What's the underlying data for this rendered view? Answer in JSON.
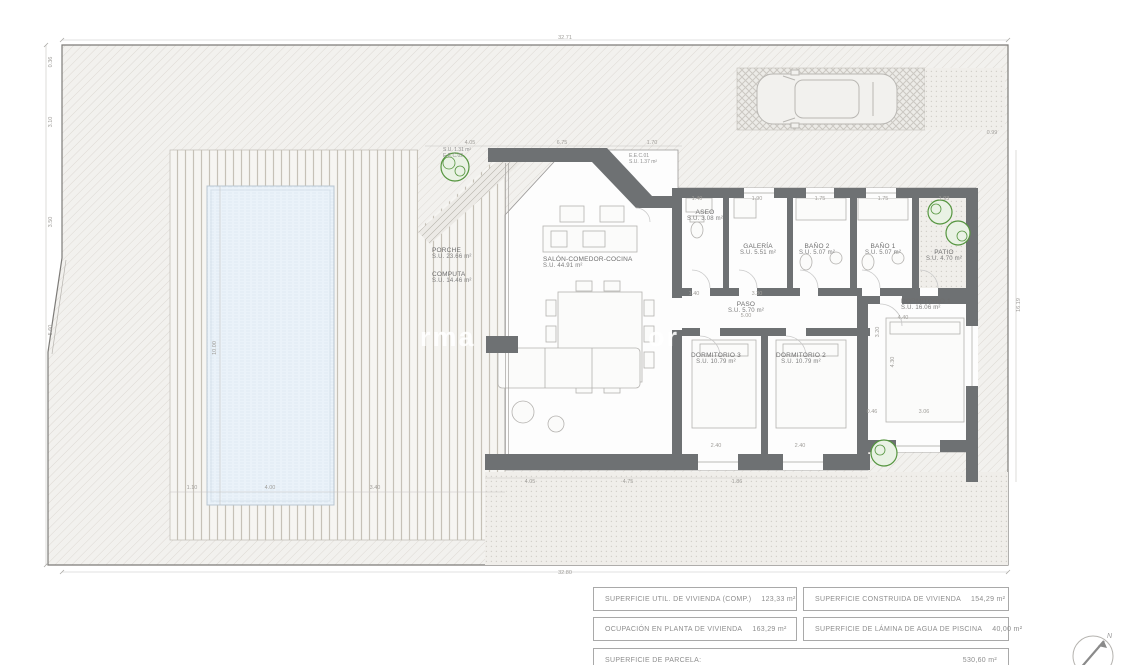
{
  "plan": {
    "rooms": [
      {
        "name": "PORCHE",
        "area": "S.U. 23.66 m²",
        "x": 432,
        "y": 247,
        "align": "left"
      },
      {
        "name": "COMPUTA",
        "area": "S.U. 14.46 m²",
        "x": 432,
        "y": 271,
        "align": "left"
      },
      {
        "name": "SALÓN-COMEDOR-COCINA",
        "area": "S.U. 44.91 m²",
        "x": 543,
        "y": 256,
        "align": "left"
      },
      {
        "name": "ASEO",
        "area": "S.U. 3.08 m²",
        "x": 705,
        "y": 209,
        "align": "center"
      },
      {
        "name": "GALERÍA",
        "area": "S.U. 5.51 m²",
        "x": 758,
        "y": 243,
        "align": "center"
      },
      {
        "name": "BAÑO 2",
        "area": "S.U. 5.07 m²",
        "x": 817,
        "y": 243,
        "align": "center"
      },
      {
        "name": "BAÑO 1",
        "area": "S.U. 5.07 m²",
        "x": 883,
        "y": 243,
        "align": "center"
      },
      {
        "name": "PATIO",
        "area": "S.U. 4.70 m²",
        "x": 944,
        "y": 249,
        "align": "center"
      },
      {
        "name": "PASO",
        "area": "S.U. 5.70 m²",
        "x": 746,
        "y": 301,
        "align": "center"
      },
      {
        "name": "DORMITORIO 1",
        "area": "S.U. 16.06 m²",
        "x": 901,
        "y": 298,
        "align": "left"
      },
      {
        "name": "DORMITORIO 3",
        "area": "S.U. 10.79 m²",
        "x": 716,
        "y": 352,
        "align": "center"
      },
      {
        "name": "DORMITORIO 2",
        "area": "S.U. 10.79 m²",
        "x": 801,
        "y": 352,
        "align": "center"
      }
    ],
    "small_labels": [
      {
        "lines": [
          "S.U. 1.31 m²",
          "E.E.C.02"
        ],
        "x": 443,
        "y": 148
      },
      {
        "lines": [
          "E.E.C.01",
          "S.U. 1.37 m²"
        ],
        "x": 629,
        "y": 154
      }
    ],
    "dims": [
      {
        "t": "32.71",
        "x": 565,
        "y": 38,
        "r": 0
      },
      {
        "t": "32.80",
        "x": 565,
        "y": 573,
        "r": 0
      },
      {
        "t": "0.36",
        "x": 51,
        "y": 62,
        "r": -90
      },
      {
        "t": "3.10",
        "x": 51,
        "y": 122,
        "r": -90
      },
      {
        "t": "3.50",
        "x": 51,
        "y": 222,
        "r": -90
      },
      {
        "t": "5.60",
        "x": 51,
        "y": 330,
        "r": -90
      },
      {
        "t": "16.19",
        "x": 1019,
        "y": 305,
        "r": -90
      },
      {
        "t": "4.05",
        "x": 470,
        "y": 143,
        "r": 0
      },
      {
        "t": "6.75",
        "x": 562,
        "y": 143,
        "r": 0
      },
      {
        "t": "1.70",
        "x": 652,
        "y": 143,
        "r": 0
      },
      {
        "t": "0.99",
        "x": 992,
        "y": 133,
        "r": 0
      },
      {
        "t": "1.40",
        "x": 697,
        "y": 199,
        "r": 0
      },
      {
        "t": "1.90",
        "x": 757,
        "y": 199,
        "r": 0
      },
      {
        "t": "1.75",
        "x": 820,
        "y": 199,
        "r": 0
      },
      {
        "t": "1.75",
        "x": 883,
        "y": 199,
        "r": 0
      },
      {
        "t": "1.93",
        "x": 944,
        "y": 199,
        "r": 0
      },
      {
        "t": "1.40",
        "x": 694,
        "y": 294,
        "r": 0
      },
      {
        "t": "3.30",
        "x": 757,
        "y": 294,
        "r": 0
      },
      {
        "t": "5.00",
        "x": 746,
        "y": 316,
        "r": 0
      },
      {
        "t": "4.40",
        "x": 903,
        "y": 318,
        "r": 0
      },
      {
        "t": "3.06",
        "x": 924,
        "y": 412,
        "r": 0
      },
      {
        "t": "0.46",
        "x": 872,
        "y": 412,
        "r": 0
      },
      {
        "t": "4.30",
        "x": 893,
        "y": 362,
        "r": -90
      },
      {
        "t": "3.20",
        "x": 878,
        "y": 332,
        "r": -90
      },
      {
        "t": "10.00",
        "x": 215,
        "y": 348,
        "r": -90
      },
      {
        "t": "1.10",
        "x": 192,
        "y": 488,
        "r": 0
      },
      {
        "t": "4.00",
        "x": 270,
        "y": 488,
        "r": 0
      },
      {
        "t": "3.40",
        "x": 375,
        "y": 488,
        "r": 0
      },
      {
        "t": "2.40",
        "x": 716,
        "y": 446,
        "r": 0
      },
      {
        "t": "2.40",
        "x": 800,
        "y": 446,
        "r": 0
      },
      {
        "t": "4.05",
        "x": 530,
        "y": 482,
        "r": 0
      },
      {
        "t": "4.75",
        "x": 628,
        "y": 482,
        "r": 0
      },
      {
        "t": "1.86",
        "x": 737,
        "y": 482,
        "r": 0
      }
    ],
    "watermark_fragments": [
      {
        "text": "rma",
        "x": 420,
        "y": 322
      },
      {
        "text": "or",
        "x": 648,
        "y": 322
      }
    ]
  },
  "summary": {
    "rows": [
      {
        "label": "SUPERFICIE UTIL. DE VIVIENDA (COMP.)",
        "value": "123,33  m²"
      },
      {
        "label": "SUPERFICIE CONSTRUIDA DE VIVIENDA",
        "value": "154,29  m²"
      },
      {
        "label": "OCUPACIÓN EN PLANTA DE VIVIENDA",
        "value": "163,29  m²"
      },
      {
        "label": "SUPERFICIE DE LÁMINA DE AGUA DE PISCINA",
        "value": "40,00  m²"
      },
      {
        "label": "SUPERFICIE DE PARCELA:",
        "value": "530,60 m²"
      }
    ]
  },
  "compass": {
    "label": "N"
  }
}
